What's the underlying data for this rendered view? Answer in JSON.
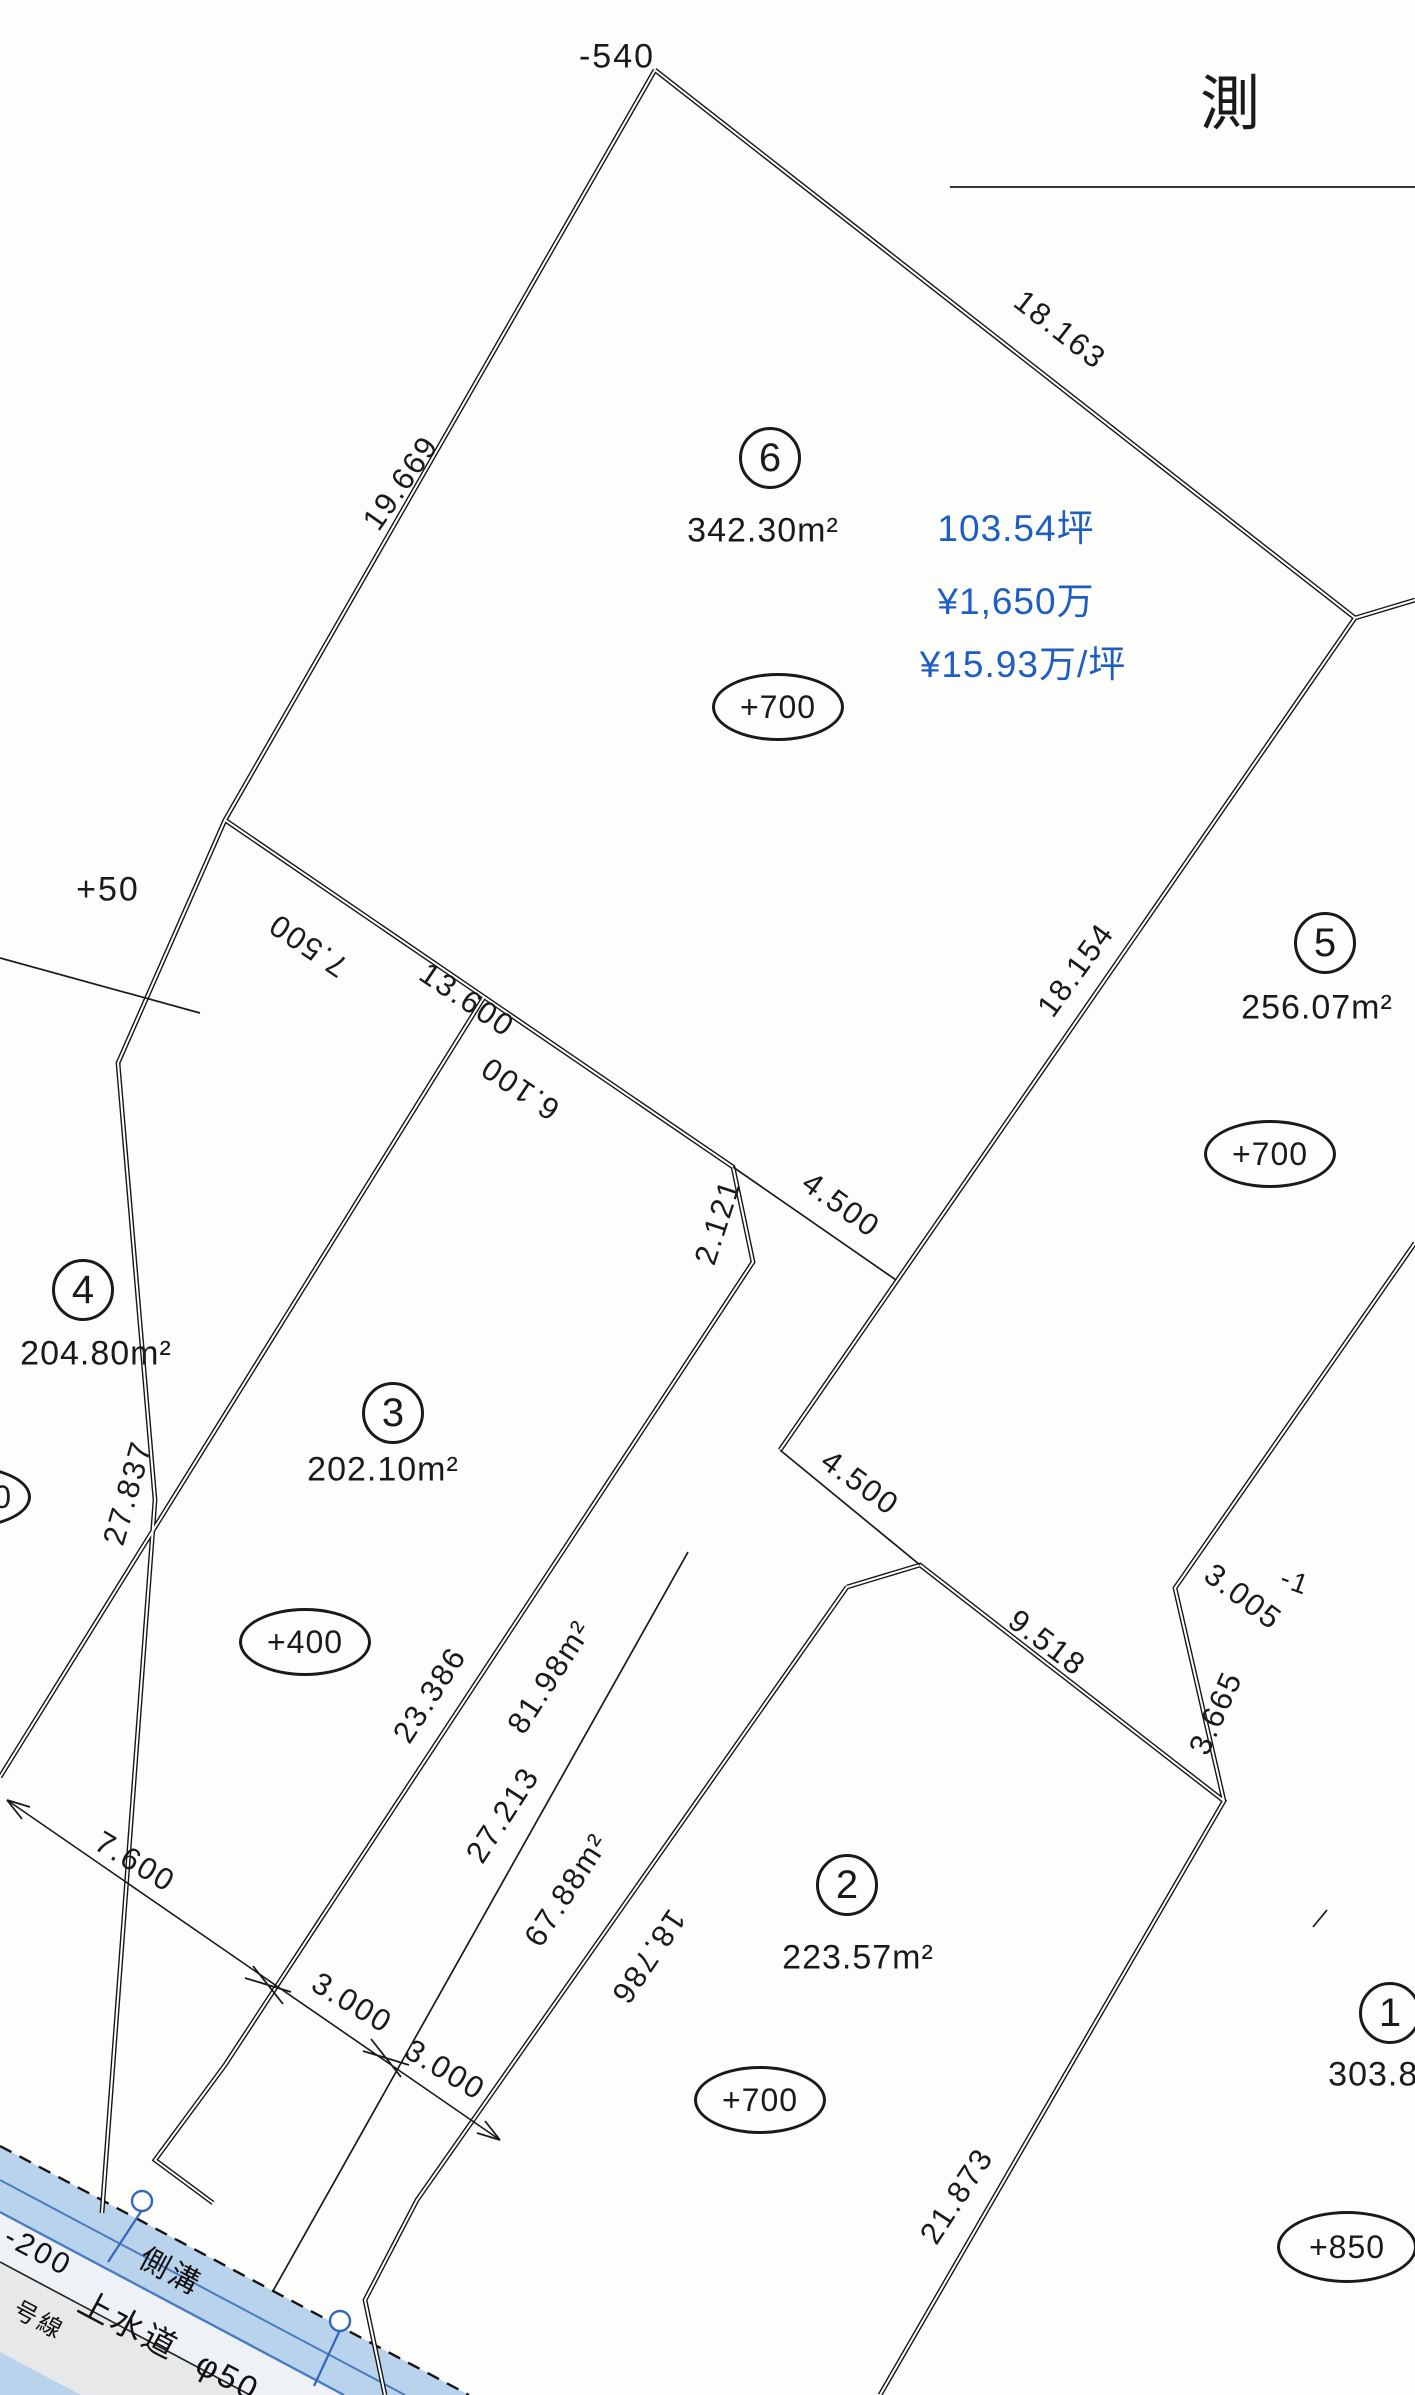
{
  "title": {
    "text": "測"
  },
  "colors": {
    "price_blue": "#1e5ec2",
    "ink": "#1a1a1a",
    "road_blue": "#b9d3ec",
    "road_edge_blue": "#4a7cc0",
    "road_gray": "#e7e8ea"
  },
  "parcels": {
    "p6": {
      "number": "6",
      "area": "342.30m²",
      "tsubo": "103.54坪",
      "price": "¥1,650万",
      "price_per_tsubo": "¥15.93万/坪",
      "elevation": "+700"
    },
    "p5": {
      "number": "5",
      "area": "256.07m²",
      "elevation": "+700"
    },
    "p4": {
      "number": "4",
      "area": "204.80m²"
    },
    "p3": {
      "number": "3",
      "area": "202.10m²",
      "elevation": "+400"
    },
    "p2": {
      "number": "2",
      "area": "223.57m²",
      "elevation": "+700"
    },
    "p1": {
      "number": "1",
      "area": "303.80m²",
      "elevation": "+850"
    }
  },
  "strips": {
    "a": "81.98m²",
    "b": "67.88m²"
  },
  "dims": {
    "top_elev": "-540",
    "plus50": "+50",
    "partial_zero": "0",
    "d18163": "18.163",
    "d19669": "19.669",
    "d7500": "7.500",
    "d13600": "13.600",
    "d6100": "6.100",
    "d2121": "2.121",
    "d4500a": "4.500",
    "d18154": "18.154",
    "d4500b": "4.500",
    "d27837": "27.837",
    "d23386": "23.386",
    "d27213": "27.213",
    "d18786": "18.786",
    "d9518": "9.518",
    "d3005": "3.005",
    "dneg1": "-1",
    "d3665": "3.665",
    "d21873": "21.873",
    "d7600": "7.600",
    "d3000a": "3.000",
    "d3000b": "3.000"
  },
  "road": {
    "gutter": "側溝",
    "waterline": "上水道",
    "pipe": "φ50",
    "depth": "-200",
    "route": "号線"
  }
}
